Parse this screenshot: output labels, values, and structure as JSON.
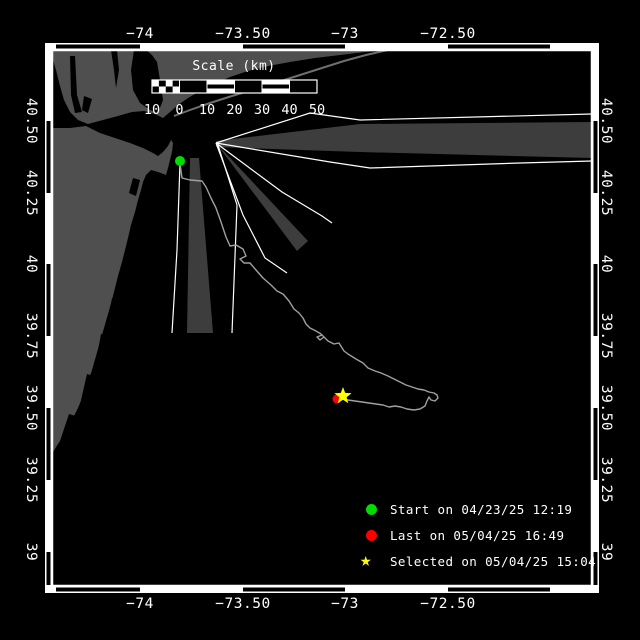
{
  "colors": {
    "background": "#000000",
    "land": "#4f4f4f",
    "water": "#000000",
    "barrier": "#6f6f6f",
    "wedge": "#3d3d3d",
    "fan_line": "#ffffff",
    "trajectory": "#a0a0a0",
    "frame": "#ffffff",
    "text": "#ffffff",
    "start": "#00dd00",
    "last": "#ff0000",
    "selected": "#ffff00"
  },
  "axes": {
    "lon_labels": [
      {
        "text": "−74",
        "x": 140
      },
      {
        "text": "−73.50",
        "x": 243
      },
      {
        "text": "−73",
        "x": 345
      },
      {
        "text": "−72.50",
        "x": 448
      }
    ],
    "lat_labels": [
      {
        "text": "40.50",
        "y": 121
      },
      {
        "text": "40.25",
        "y": 193
      },
      {
        "text": "40",
        "y": 264
      },
      {
        "text": "39.75",
        "y": 336
      },
      {
        "text": "39.50",
        "y": 408
      },
      {
        "text": "39.25",
        "y": 480
      },
      {
        "text": "39",
        "y": 552
      }
    ],
    "top_label_y": 26,
    "bottom_label_y": 596,
    "left_label_x": 31,
    "right_label_x": 606
  },
  "scalebar": {
    "title": "Scale (km)",
    "tick_labels": [
      "10",
      "0",
      "10",
      "20",
      "30",
      "40",
      "50"
    ],
    "x0": 152,
    "x1": 317,
    "y": 80,
    "height": 13,
    "title_center_x": 234,
    "title_y": 59,
    "labels_y": 102
  },
  "legend": {
    "items": [
      {
        "marker": "circle",
        "color": "#00dd00",
        "label": "Start on 04/23/25 12:19"
      },
      {
        "marker": "circle",
        "color": "#ff0000",
        "label": "Last on 05/04/25 16:49"
      },
      {
        "marker": "star",
        "color": "#ffff00",
        "label": "Selected on 05/04/25 15:04"
      }
    ]
  },
  "markers": {
    "start": {
      "x": 180,
      "y": 161,
      "r": 5
    },
    "last": {
      "x": 337,
      "y": 399,
      "r": 4.5
    },
    "selected": {
      "x": 343,
      "y": 396,
      "R": 9,
      "r": 3.8
    }
  },
  "frame": {
    "inner": [
      52,
      50,
      540,
      536
    ],
    "outer": [
      45,
      43,
      554,
      550
    ],
    "black_segs_h": [
      [
        56,
        140
      ],
      [
        243,
        345
      ],
      [
        448,
        550
      ]
    ],
    "black_segs_v": [
      [
        121,
        193
      ],
      [
        264,
        336
      ],
      [
        408,
        480
      ],
      [
        552,
        585
      ]
    ]
  },
  "geometry": {
    "land": [
      [
        [
          53,
          50
        ],
        [
          390,
          50
        ],
        [
          365,
          52
        ],
        [
          340,
          55
        ],
        [
          315,
          58
        ],
        [
          290,
          62
        ],
        [
          268,
          66
        ],
        [
          248,
          71
        ],
        [
          230,
          77
        ],
        [
          214,
          84
        ],
        [
          200,
          91
        ],
        [
          188,
          98
        ],
        [
          178,
          105
        ],
        [
          170,
          112
        ],
        [
          163,
          118
        ],
        [
          155,
          114
        ],
        [
          144,
          111
        ],
        [
          132,
          112
        ],
        [
          118,
          116
        ],
        [
          103,
          120
        ],
        [
          88,
          124
        ],
        [
          78,
          120
        ],
        [
          70,
          112
        ],
        [
          64,
          100
        ],
        [
          60,
          86
        ],
        [
          56,
          70
        ],
        [
          53,
          60
        ]
      ],
      [
        [
          53,
          128
        ],
        [
          70,
          128
        ],
        [
          86,
          126
        ],
        [
          100,
          133
        ],
        [
          115,
          138
        ],
        [
          130,
          143
        ],
        [
          143,
          148
        ],
        [
          153,
          153
        ],
        [
          158,
          156
        ],
        [
          163,
          152
        ],
        [
          168,
          146
        ],
        [
          171,
          140
        ],
        [
          173,
          143
        ],
        [
          172,
          152
        ],
        [
          170,
          160
        ],
        [
          168,
          168
        ],
        [
          166,
          175
        ],
        [
          158,
          172
        ],
        [
          151,
          170
        ],
        [
          146,
          175
        ],
        [
          143,
          182
        ],
        [
          141,
          190
        ],
        [
          138,
          200
        ],
        [
          135,
          212
        ],
        [
          131,
          225
        ],
        [
          128,
          238
        ],
        [
          125,
          250
        ],
        [
          122,
          262
        ],
        [
          118,
          276
        ],
        [
          115,
          288
        ],
        [
          112,
          300
        ],
        [
          108,
          314
        ],
        [
          104,
          328
        ],
        [
          100,
          342
        ],
        [
          96,
          356
        ],
        [
          92,
          370
        ],
        [
          88,
          382
        ],
        [
          83,
          396
        ],
        [
          78,
          408
        ],
        [
          72,
          420
        ],
        [
          66,
          432
        ],
        [
          58,
          444
        ],
        [
          53,
          452
        ]
      ]
    ],
    "water_cutouts": [
      [
        [
          111,
          50
        ],
        [
          114,
          70
        ],
        [
          116,
          88
        ],
        [
          119,
          70
        ],
        [
          117,
          50
        ]
      ],
      [
        [
          134,
          50
        ],
        [
          131,
          70
        ],
        [
          133,
          90
        ],
        [
          140,
          103
        ],
        [
          150,
          110
        ],
        [
          158,
          113
        ],
        [
          163,
          100
        ],
        [
          160,
          80
        ],
        [
          157,
          62
        ],
        [
          152,
          55
        ],
        [
          146,
          50
        ]
      ],
      [
        [
          70,
          56
        ],
        [
          75,
          56
        ],
        [
          77,
          95
        ],
        [
          82,
          112
        ],
        [
          75,
          113
        ],
        [
          71,
          95
        ]
      ],
      [
        [
          84,
          96
        ],
        [
          92,
          99
        ],
        [
          88,
          113
        ],
        [
          82,
          110
        ]
      ],
      [
        [
          133,
          178
        ],
        [
          140,
          180
        ],
        [
          136,
          196
        ],
        [
          129,
          193
        ]
      ],
      [
        [
          138,
          228
        ],
        [
          143,
          230
        ],
        [
          140,
          244
        ],
        [
          134,
          242
        ]
      ],
      [
        [
          128,
          258
        ],
        [
          134,
          260
        ],
        [
          130,
          276
        ],
        [
          124,
          274
        ]
      ],
      [
        [
          112,
          298
        ],
        [
          122,
          301
        ],
        [
          117,
          330
        ],
        [
          107,
          327
        ]
      ],
      [
        [
          101,
          334
        ],
        [
          111,
          337
        ],
        [
          104,
          371
        ],
        [
          95,
          367
        ]
      ],
      [
        [
          87,
          374
        ],
        [
          97,
          377
        ],
        [
          89,
          414
        ],
        [
          79,
          409
        ]
      ],
      [
        [
          69,
          414
        ],
        [
          79,
          417
        ],
        [
          71,
          447
        ],
        [
          59,
          444
        ]
      ]
    ],
    "barrier_lines": [
      [
        [
          174,
          116
        ],
        [
          190,
          110
        ],
        [
          210,
          103
        ],
        [
          232,
          96
        ],
        [
          255,
          89
        ],
        [
          278,
          82
        ],
        [
          300,
          75
        ],
        [
          322,
          68
        ],
        [
          344,
          61
        ],
        [
          366,
          55
        ],
        [
          388,
          50
        ]
      ]
    ],
    "wedges": [
      [
        [
          216,
          141
        ],
        [
          360,
          124
        ],
        [
          592,
          122
        ],
        [
          592,
          158
        ],
        [
          360,
          152
        ],
        [
          216,
          147
        ]
      ],
      [
        [
          216,
          143
        ],
        [
          308,
          241
        ],
        [
          297,
          251
        ]
      ],
      [
        [
          190,
          158
        ],
        [
          199,
          158
        ],
        [
          213,
          333
        ],
        [
          187,
          333
        ]
      ]
    ],
    "fan_lines": [
      [
        [
          216,
          143
        ],
        [
          310,
          113
        ],
        [
          360,
          120
        ],
        [
          592,
          114
        ]
      ],
      [
        [
          216,
          143
        ],
        [
          330,
          162
        ],
        [
          370,
          168
        ],
        [
          520,
          163
        ],
        [
          592,
          161
        ]
      ],
      [
        [
          216,
          143
        ],
        [
          282,
          192
        ],
        [
          322,
          216
        ],
        [
          332,
          223
        ]
      ],
      [
        [
          216,
          143
        ],
        [
          243,
          215
        ],
        [
          265,
          258
        ],
        [
          287,
          273
        ]
      ],
      [
        [
          218,
          145
        ],
        [
          237,
          205
        ],
        [
          232,
          333
        ]
      ],
      [
        [
          180,
          163
        ],
        [
          177,
          250
        ],
        [
          172,
          333
        ]
      ]
    ],
    "trajectory": [
      [
        180,
        163
      ],
      [
        181,
        171
      ],
      [
        182,
        178
      ],
      [
        190,
        180
      ],
      [
        202,
        181
      ],
      [
        206,
        187
      ],
      [
        211,
        198
      ],
      [
        216,
        208
      ],
      [
        221,
        222
      ],
      [
        226,
        237
      ],
      [
        230,
        246
      ],
      [
        236,
        245
      ],
      [
        243,
        249
      ],
      [
        246,
        256
      ],
      [
        240,
        259
      ],
      [
        244,
        263
      ],
      [
        250,
        263
      ],
      [
        256,
        270
      ],
      [
        263,
        278
      ],
      [
        271,
        285
      ],
      [
        277,
        291
      ],
      [
        283,
        294
      ],
      [
        289,
        301
      ],
      [
        294,
        309
      ],
      [
        299,
        313
      ],
      [
        303,
        318
      ],
      [
        306,
        324
      ],
      [
        310,
        328
      ],
      [
        316,
        331
      ],
      [
        321,
        334
      ],
      [
        324,
        337
      ],
      [
        320,
        340
      ],
      [
        317,
        337
      ],
      [
        322,
        335
      ],
      [
        328,
        341
      ],
      [
        334,
        344
      ],
      [
        339,
        343
      ],
      [
        344,
        351
      ],
      [
        348,
        354
      ],
      [
        356,
        359
      ],
      [
        363,
        363
      ],
      [
        368,
        368
      ],
      [
        375,
        371
      ],
      [
        381,
        373
      ],
      [
        388,
        376
      ],
      [
        394,
        379
      ],
      [
        400,
        382
      ],
      [
        406,
        385
      ],
      [
        412,
        387
      ],
      [
        418,
        389
      ],
      [
        424,
        390
      ],
      [
        429,
        392
      ],
      [
        434,
        393
      ],
      [
        437,
        395
      ],
      [
        438,
        398
      ],
      [
        435,
        401
      ],
      [
        431,
        400
      ],
      [
        429,
        397
      ],
      [
        427,
        401
      ],
      [
        425,
        406
      ],
      [
        420,
        409
      ],
      [
        414,
        410
      ],
      [
        407,
        409
      ],
      [
        401,
        407
      ],
      [
        395,
        406
      ],
      [
        389,
        407
      ],
      [
        383,
        405
      ],
      [
        376,
        404
      ],
      [
        369,
        403
      ],
      [
        362,
        402
      ],
      [
        355,
        401
      ],
      [
        348,
        400
      ],
      [
        342,
        399
      ],
      [
        338,
        399
      ]
    ]
  }
}
